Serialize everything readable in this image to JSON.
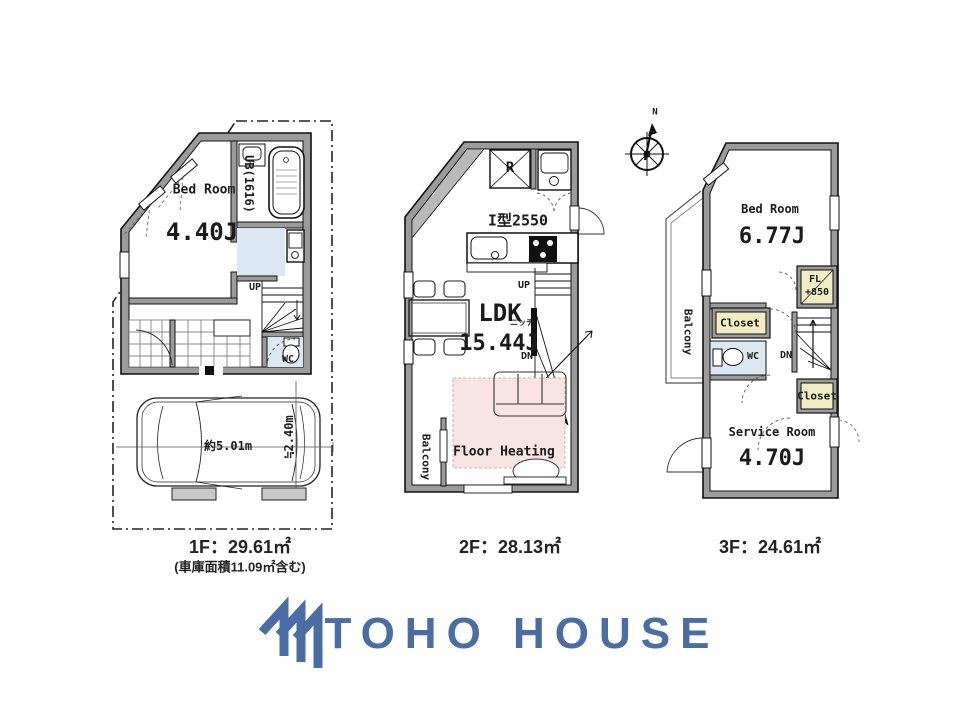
{
  "colors": {
    "wall_fill": "#9b9b9b",
    "line": "#1b1b1b",
    "floor_heating_pink": "#f8e4e3",
    "closet_yellow": "#f1edc2",
    "water_blue": "#dce8f1",
    "logo_blue": "#4a6da3"
  },
  "compass": {
    "north_label": "N"
  },
  "floor1": {
    "bedroom_name": "Bed Room",
    "bedroom_size": "4.40J",
    "bath_label": "UB(1616)",
    "stairs_up": "UP",
    "wc_label": "WC",
    "car_length": "約5.01m",
    "car_width": "≒2.40m",
    "area_label": "1F：29.61㎡",
    "area_note": "(車庫面積11.09㎡含む)"
  },
  "floor2": {
    "fridge_label": "R",
    "kitchen_type": "I型2550",
    "stairs_up": "UP",
    "stairs_down": "DN",
    "niche_label": "ニッチ",
    "room_name": "LDK",
    "room_size": "15.44J",
    "floor_heating_label": "Floor Heating",
    "balcony_label": "Balcony",
    "area_label": "2F：28.13㎡"
  },
  "floor3": {
    "bedroom_name": "Bed Room",
    "bedroom_size": "6.77J",
    "fl_line1": "FL",
    "fl_line2": "+850",
    "closet_upper": "Closet",
    "wc_label": "WC",
    "stairs_down": "DN",
    "closet_lower": "Closet",
    "service_name": "Service Room",
    "service_size": "4.70J",
    "balcony_label": "Balcony",
    "area_label": "3F：24.61㎡"
  },
  "logo": {
    "brand": "TOHO HOUSE"
  }
}
